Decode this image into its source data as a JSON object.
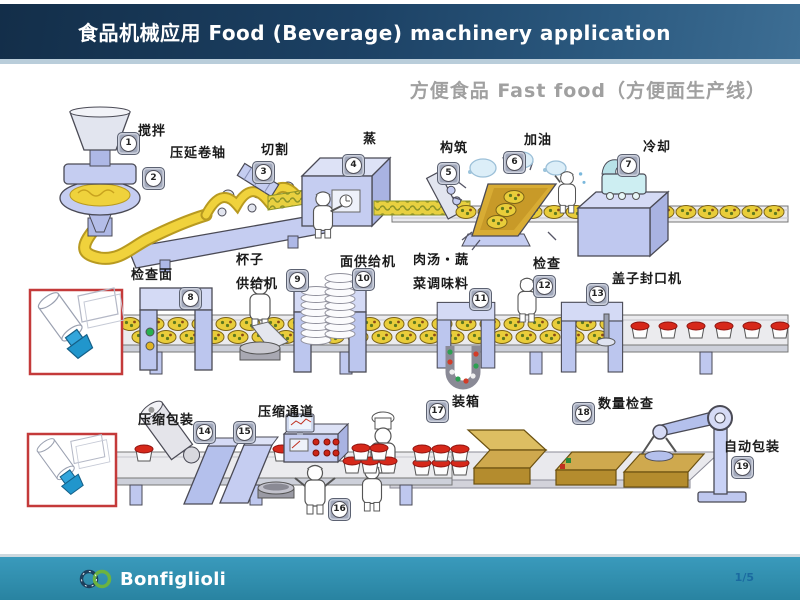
{
  "header": {
    "title": "食品机械应用  Food (Beverage) machinery application"
  },
  "subtitle": "方便食品 Fast food（方便面生产线）",
  "stations": [
    {
      "number": "1",
      "label": "搅拌"
    },
    {
      "number": "2",
      "label": "压延卷轴"
    },
    {
      "number": "3",
      "label": "切割"
    },
    {
      "number": "4",
      "label": "蒸"
    },
    {
      "number": "5",
      "label": "构筑"
    },
    {
      "number": "6",
      "label": "加油"
    },
    {
      "number": "7",
      "label": "冷却"
    },
    {
      "number": "8",
      "label": "检查面"
    },
    {
      "number": "9",
      "label": "杯子\n供给机"
    },
    {
      "number": "10",
      "label": "面供给机"
    },
    {
      "number": "11",
      "label": "肉汤・蔬\n菜调味料"
    },
    {
      "number": "12",
      "label": "检查"
    },
    {
      "number": "13",
      "label": "盖子封口机"
    },
    {
      "number": "14",
      "label": "压缩包装"
    },
    {
      "number": "15",
      "label": "压缩通道"
    },
    {
      "number": "16",
      "label": ""
    },
    {
      "number": "17",
      "label": "装箱"
    },
    {
      "number": "18",
      "label": "数量检查"
    },
    {
      "number": "19",
      "label": "自动包装"
    }
  ],
  "footer": {
    "brand": "Bonfiglioli",
    "page": "1/5"
  },
  "colors": {
    "header_gradient_dark": "#132e49",
    "header_gradient_light": "#3d6e94",
    "footer_teal": "#2f8cab",
    "callout_red": "#c43a3a",
    "machine_periwinkle": "#c5cdf1",
    "noodle_yellow": "#e9cd3a",
    "cup_lid_red": "#d6281a",
    "box_tan": "#cfa94e",
    "logo_green": "#6cb33f",
    "page_number_blue": "#1a6aa0"
  }
}
